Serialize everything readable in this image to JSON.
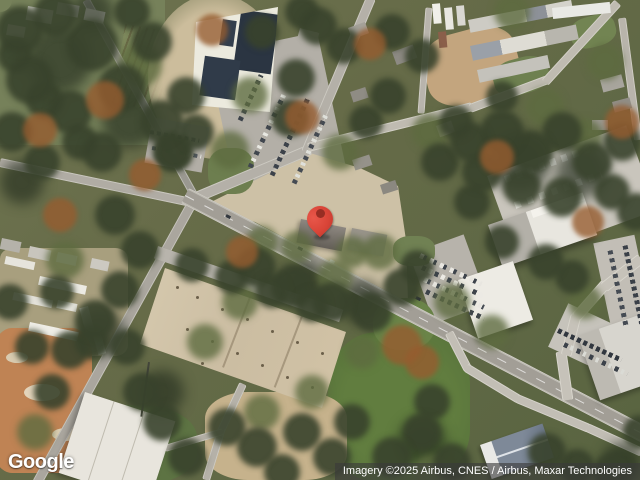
{
  "map": {
    "view": "satellite",
    "logo": "Google",
    "attribution": "Imagery ©2025 Airbus, CNES / Airbus, Maxar Technologies",
    "pin": {
      "color": "#D94437",
      "inner_color": "#972D23"
    },
    "palette": {
      "road": "#A8A49E",
      "trees_dark": "#38422C",
      "grass": "#6B7A4E",
      "warehouse_roof": "#D2C5AB",
      "construction_dirt": "#BF8354",
      "solar_panels": "#2B3542",
      "white_roof": "#EBE9E2"
    }
  }
}
